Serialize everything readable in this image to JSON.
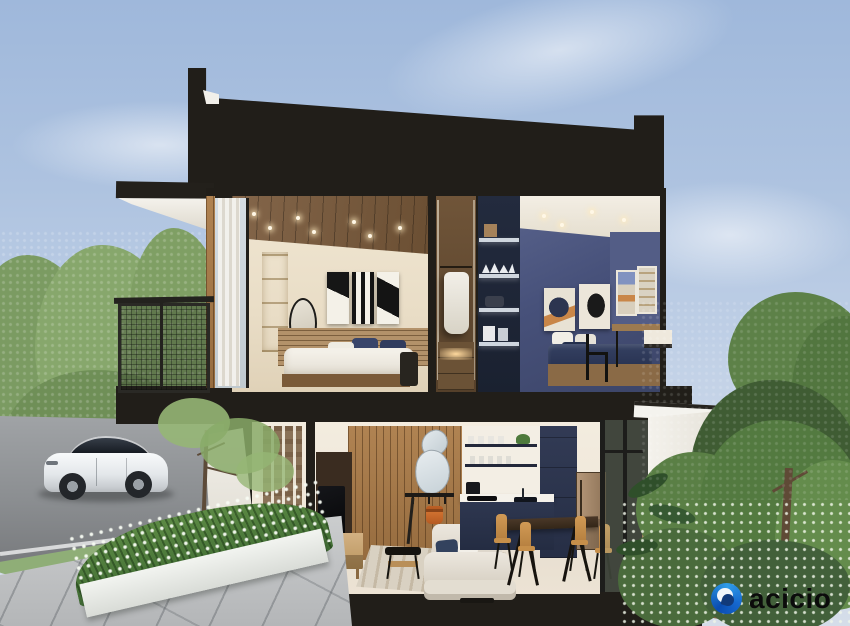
{
  "logo": {
    "brand_text": "acicio",
    "icon": "swirl-circle-icon",
    "icon_color_start": "#0a4cb0",
    "icon_color_end": "#2f9ce8",
    "text_color": "#0b0b0b"
  },
  "palette": {
    "sky_top": "#9fb8db",
    "sky_bottom": "#d5dde9",
    "cut_section_black": "#211e19",
    "bedroom_wall_cream": "#eadfca",
    "wood_ceiling": "#7c5f3e",
    "navy_bedroom_wall": "#47517a",
    "navy_kitchen_cabinet": "#2b3349",
    "living_slat_wood": "#a87c4c",
    "sofa_cream": "#e8e3da",
    "accent_orange_bag": "#c8682b",
    "dining_chair_tan": "#c68f4a",
    "fridge_bronze": "#a58868",
    "tree_green_left": "#87a76c",
    "tree_green_right": "#537a40",
    "road_gray": "#9a9da0",
    "paving_gray": "#c3c5c6",
    "car_white": "#eef0f2"
  }
}
